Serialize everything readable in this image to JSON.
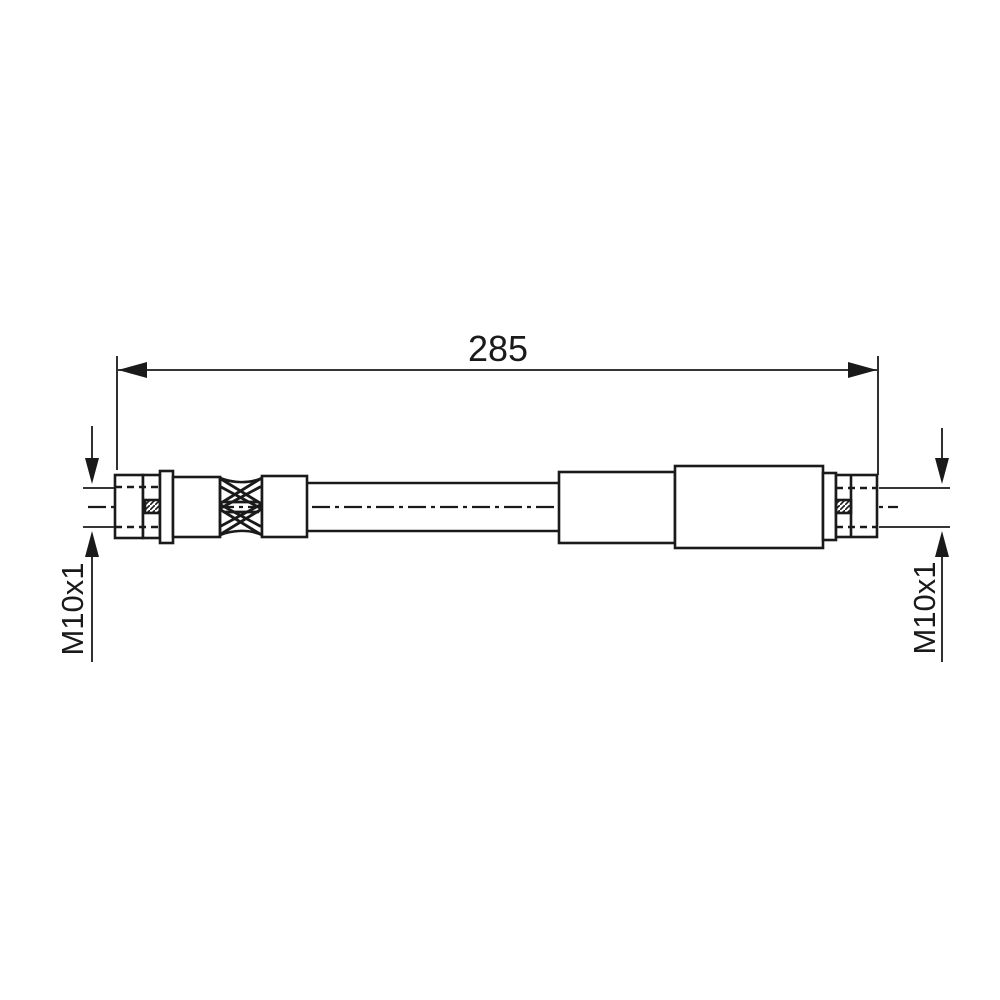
{
  "page": {
    "background_color": "#ffffff",
    "line_color": "#1a1a1a"
  },
  "drawing": {
    "kind": "brake-hose-technical-drawing",
    "dimension": {
      "length_label": "285"
    },
    "left_thread_callout": {
      "label": "M10x1"
    },
    "right_thread_callout": {
      "label": "M10x1"
    }
  }
}
